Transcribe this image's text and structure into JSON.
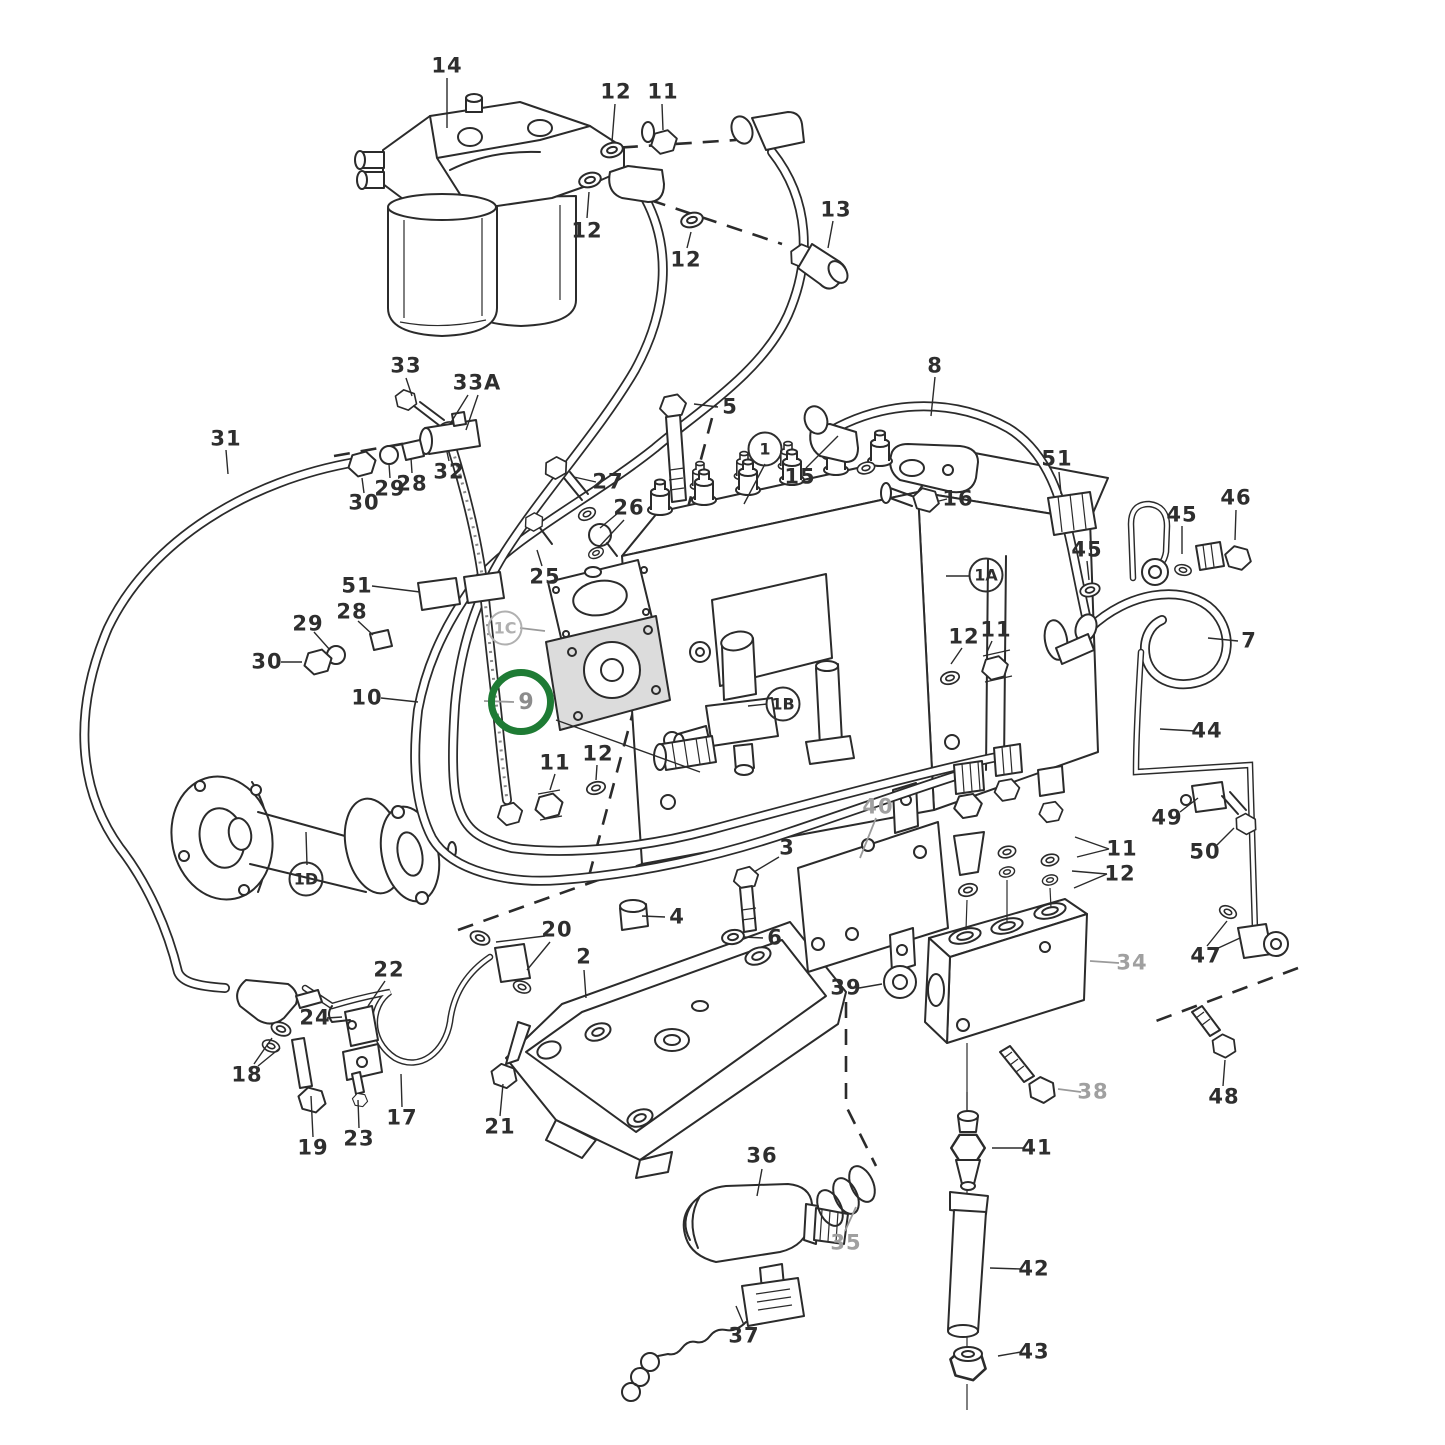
{
  "figure": {
    "kind": "exploded parts diagram",
    "highlighted_part": "9"
  },
  "colors": {
    "line": "#2b2b2b",
    "gray_label": "#a0a0a0",
    "highlight_ring": "#1e7b34",
    "background": "#ffffff"
  },
  "callouts": [
    {
      "t": "14",
      "x": 447,
      "y": 66,
      "s": "p"
    },
    {
      "t": "12",
      "x": 616,
      "y": 92,
      "s": "p"
    },
    {
      "t": "11",
      "x": 663,
      "y": 92,
      "s": "p"
    },
    {
      "t": "12",
      "x": 587,
      "y": 231,
      "s": "p"
    },
    {
      "t": "12",
      "x": 686,
      "y": 260,
      "s": "p"
    },
    {
      "t": "13",
      "x": 836,
      "y": 210,
      "s": "p"
    },
    {
      "t": "33",
      "x": 406,
      "y": 366,
      "s": "p"
    },
    {
      "t": "33A",
      "x": 477,
      "y": 383,
      "s": "p"
    },
    {
      "t": "31",
      "x": 226,
      "y": 439,
      "s": "p"
    },
    {
      "t": "30",
      "x": 364,
      "y": 503,
      "s": "p"
    },
    {
      "t": "29",
      "x": 390,
      "y": 489,
      "s": "p"
    },
    {
      "t": "28",
      "x": 412,
      "y": 484,
      "s": "p"
    },
    {
      "t": "32",
      "x": 449,
      "y": 472,
      "s": "p"
    },
    {
      "t": "5",
      "x": 730,
      "y": 407,
      "s": "p"
    },
    {
      "t": "27",
      "x": 608,
      "y": 482,
      "s": "p"
    },
    {
      "t": "26",
      "x": 629,
      "y": 508,
      "s": "p"
    },
    {
      "t": "25",
      "x": 545,
      "y": 577,
      "s": "p"
    },
    {
      "t": "51",
      "x": 357,
      "y": 586,
      "s": "p"
    },
    {
      "t": "28",
      "x": 352,
      "y": 612,
      "s": "p"
    },
    {
      "t": "29",
      "x": 308,
      "y": 624,
      "s": "p"
    },
    {
      "t": "30",
      "x": 267,
      "y": 662,
      "s": "p"
    },
    {
      "t": "10",
      "x": 367,
      "y": 698,
      "s": "p"
    },
    {
      "t": "9",
      "x": 521,
      "y": 702,
      "s": "h"
    },
    {
      "t": "1",
      "x": 765,
      "y": 449,
      "s": "c"
    },
    {
      "t": "15",
      "x": 800,
      "y": 477,
      "s": "p"
    },
    {
      "t": "16",
      "x": 958,
      "y": 499,
      "s": "p"
    },
    {
      "t": "8",
      "x": 935,
      "y": 366,
      "s": "p"
    },
    {
      "t": "51",
      "x": 1057,
      "y": 459,
      "s": "p"
    },
    {
      "t": "45",
      "x": 1087,
      "y": 550,
      "s": "p"
    },
    {
      "t": "45",
      "x": 1182,
      "y": 515,
      "s": "p"
    },
    {
      "t": "46",
      "x": 1236,
      "y": 498,
      "s": "p"
    },
    {
      "t": "1A",
      "x": 986,
      "y": 575,
      "s": "c"
    },
    {
      "t": "12",
      "x": 964,
      "y": 637,
      "s": "p"
    },
    {
      "t": "11",
      "x": 996,
      "y": 630,
      "s": "p"
    },
    {
      "t": "7",
      "x": 1249,
      "y": 641,
      "s": "p"
    },
    {
      "t": "44",
      "x": 1207,
      "y": 731,
      "s": "p"
    },
    {
      "t": "49",
      "x": 1167,
      "y": 818,
      "s": "p"
    },
    {
      "t": "50",
      "x": 1205,
      "y": 852,
      "s": "p"
    },
    {
      "t": "11",
      "x": 1122,
      "y": 849,
      "s": "p"
    },
    {
      "t": "12",
      "x": 1120,
      "y": 874,
      "s": "p"
    },
    {
      "t": "34",
      "x": 1132,
      "y": 963,
      "s": "g"
    },
    {
      "t": "47",
      "x": 1206,
      "y": 956,
      "s": "p"
    },
    {
      "t": "1C",
      "x": 505,
      "y": 628,
      "s": "cg"
    },
    {
      "t": "1B",
      "x": 783,
      "y": 704,
      "s": "c"
    },
    {
      "t": "1D",
      "x": 306,
      "y": 879,
      "s": "c"
    },
    {
      "t": "11",
      "x": 555,
      "y": 763,
      "s": "p"
    },
    {
      "t": "12",
      "x": 598,
      "y": 754,
      "s": "p"
    },
    {
      "t": "40",
      "x": 878,
      "y": 807,
      "s": "g"
    },
    {
      "t": "3",
      "x": 787,
      "y": 848,
      "s": "p"
    },
    {
      "t": "4",
      "x": 677,
      "y": 917,
      "s": "p"
    },
    {
      "t": "6",
      "x": 775,
      "y": 938,
      "s": "p"
    },
    {
      "t": "39",
      "x": 846,
      "y": 988,
      "s": "p"
    },
    {
      "t": "20",
      "x": 557,
      "y": 930,
      "s": "p"
    },
    {
      "t": "2",
      "x": 584,
      "y": 957,
      "s": "p"
    },
    {
      "t": "22",
      "x": 389,
      "y": 970,
      "s": "p"
    },
    {
      "t": "24",
      "x": 315,
      "y": 1018,
      "s": "p"
    },
    {
      "t": "18",
      "x": 247,
      "y": 1075,
      "s": "p"
    },
    {
      "t": "19",
      "x": 313,
      "y": 1148,
      "s": "p"
    },
    {
      "t": "23",
      "x": 359,
      "y": 1139,
      "s": "p"
    },
    {
      "t": "17",
      "x": 402,
      "y": 1118,
      "s": "p"
    },
    {
      "t": "21",
      "x": 500,
      "y": 1127,
      "s": "p"
    },
    {
      "t": "36",
      "x": 762,
      "y": 1156,
      "s": "p"
    },
    {
      "t": "35",
      "x": 846,
      "y": 1243,
      "s": "g"
    },
    {
      "t": "37",
      "x": 744,
      "y": 1336,
      "s": "p"
    },
    {
      "t": "38",
      "x": 1093,
      "y": 1092,
      "s": "g"
    },
    {
      "t": "41",
      "x": 1037,
      "y": 1148,
      "s": "p"
    },
    {
      "t": "42",
      "x": 1034,
      "y": 1269,
      "s": "p"
    },
    {
      "t": "43",
      "x": 1034,
      "y": 1352,
      "s": "p"
    },
    {
      "t": "48",
      "x": 1224,
      "y": 1097,
      "s": "p"
    }
  ]
}
